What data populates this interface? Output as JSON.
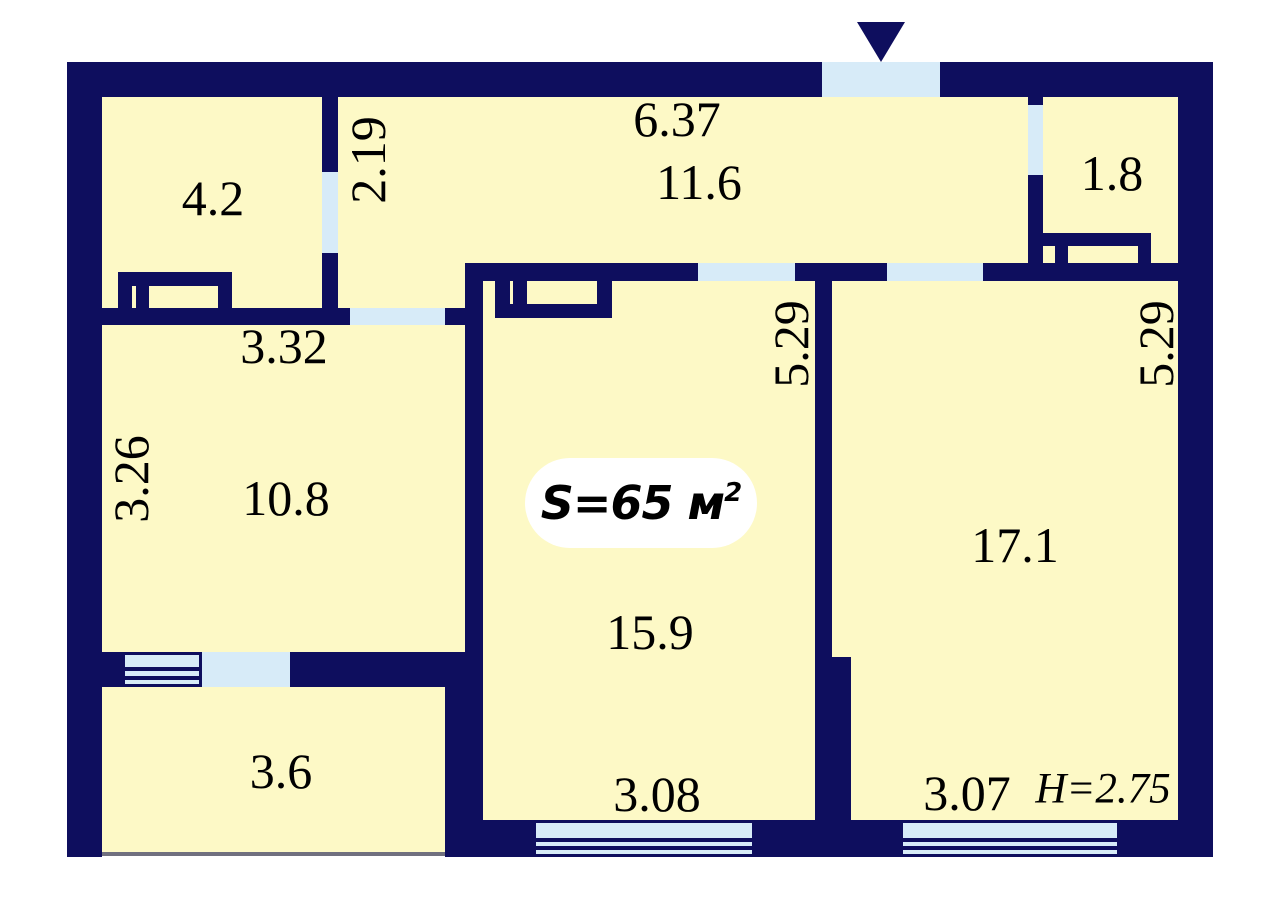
{
  "plan": {
    "total_area_badge": {
      "text": "S=65 м",
      "sup": "2"
    },
    "ceiling_height": "H=2.75",
    "entrance": {
      "marker": "triangle-down"
    },
    "rooms": [
      {
        "name": "room-top-left",
        "area": "4.2"
      },
      {
        "name": "hallway",
        "area": "11.6",
        "width_dim": "6.37",
        "passage_dim": "2.19"
      },
      {
        "name": "closet-top-right",
        "area": "1.8"
      },
      {
        "name": "room-mid-left",
        "area": "10.8",
        "width_dim": "3.32",
        "depth_dim": "3.26"
      },
      {
        "name": "living-room",
        "area": "15.9",
        "depth_dim": "5.29",
        "window_dim": "3.08"
      },
      {
        "name": "bedroom",
        "area": "17.1",
        "depth_dim": "5.29",
        "window_dim": "3.07"
      },
      {
        "name": "balcony",
        "area": "3.6"
      }
    ],
    "colors": {
      "wall": "#0e0e5e",
      "room": "#fdf9c6",
      "opening": "#d7ebf8",
      "background": "#ffffff",
      "badge_bg": "#ffffff",
      "balcony_edge": "#70707f",
      "text": "#000000"
    }
  }
}
